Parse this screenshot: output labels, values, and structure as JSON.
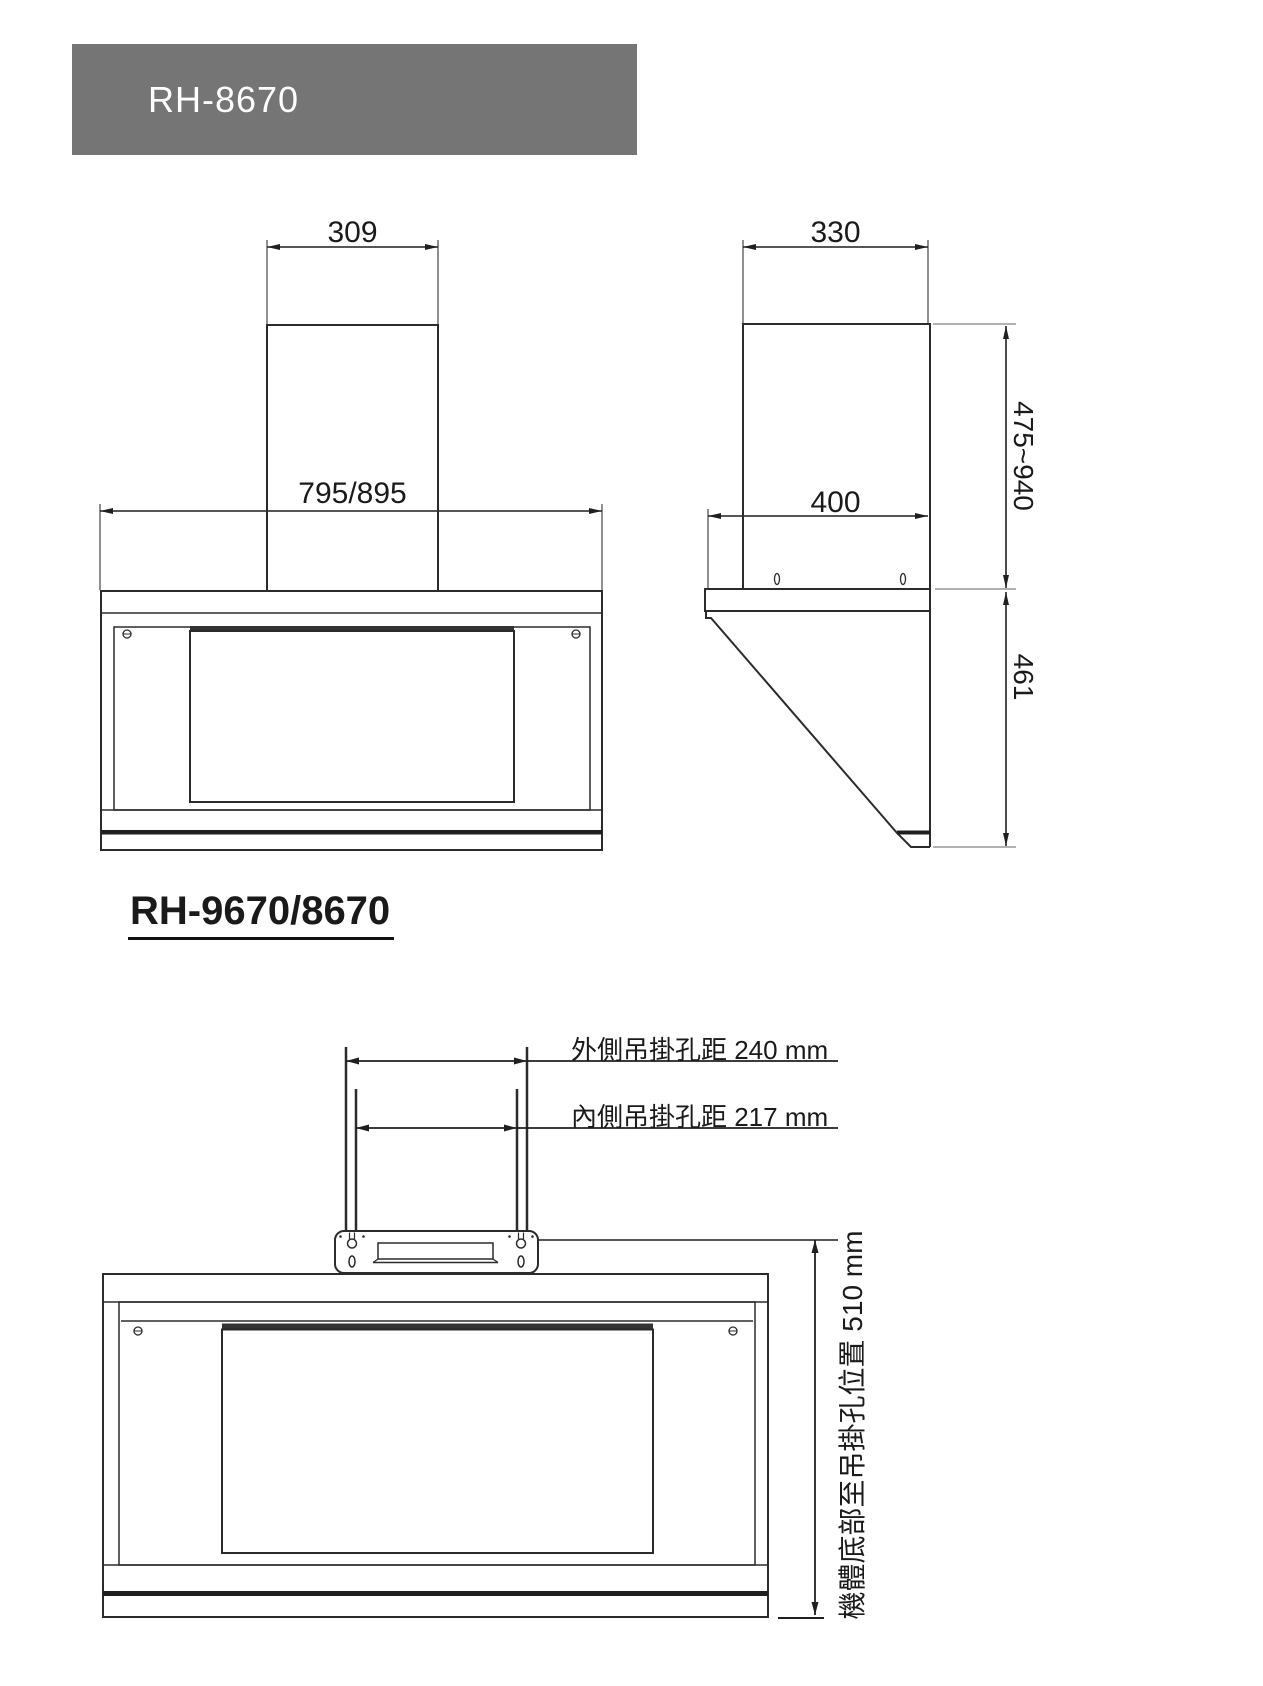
{
  "header": {
    "model_label": "RH-8670",
    "bg_color": "#757575",
    "text_color": "#ffffff"
  },
  "section": {
    "model_label": "RH-9670/8670"
  },
  "front_view": {
    "duct_width": "309",
    "body_width": "795/895"
  },
  "side_view": {
    "duct_depth": "330",
    "top_plate_depth": "400",
    "duct_height_range": "475~940",
    "body_height": "461"
  },
  "mounting_view": {
    "outer_hole_label": "外側吊掛孔距 240 mm",
    "inner_hole_label": "內側吊掛孔距 217 mm",
    "bottom_to_hole_label": "機體底部至吊掛孔位置 510 mm"
  },
  "colors": {
    "line": "#2b2b2b",
    "dim_line": "#1f1f1f",
    "extension_line": "#8a8a8a",
    "header_bg": "#757575"
  }
}
